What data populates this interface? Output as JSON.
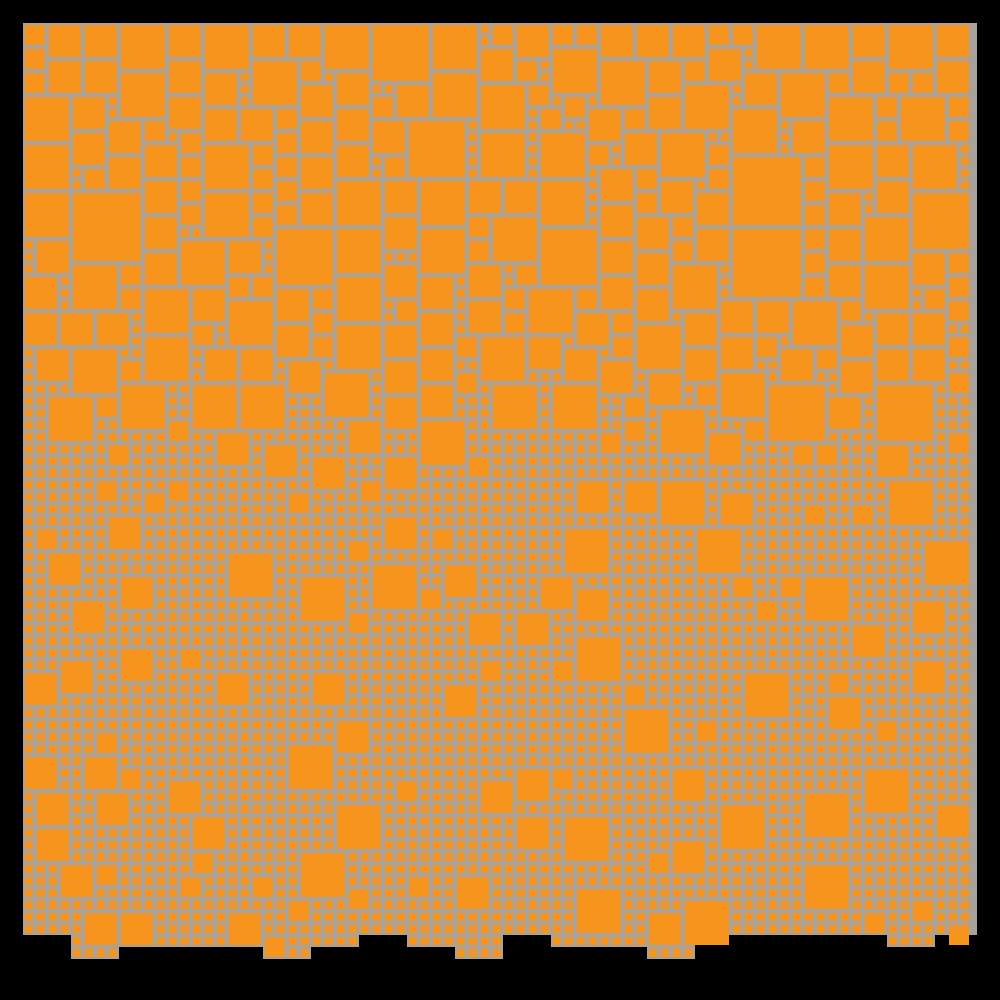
{
  "scene": {
    "description": "abstract-generative-square-mosaic",
    "text_content": "none"
  },
  "canvas": {
    "width": 1000,
    "height": 1000
  },
  "palette": {
    "frame_black": "#000000",
    "board_gray": "#a8a29b",
    "square_orange": "#f7941e"
  },
  "board": {
    "x": 23,
    "y": 23,
    "width": 954,
    "nominal_bottom": 971
  },
  "grid": {
    "cell": 12,
    "inset": 2,
    "cols": 79,
    "max_rows": 79,
    "square_sizes_px": {
      "1": 8,
      "2": 20,
      "3": 32,
      "4": 44,
      "5": 56,
      "6": 68
    }
  },
  "generator": {
    "seed": 1337,
    "block_cols": 4,
    "size_units": [
      1,
      2,
      3,
      4,
      5,
      6
    ],
    "top_weights": [
      0.12,
      0.1,
      0.31,
      0.34,
      0.09,
      0.04
    ],
    "bottom_weights": [
      0.948,
      0.018,
      0.02,
      0.014,
      0.0,
      0.0
    ],
    "transition": {
      "center_row": 31,
      "half_width_rows": 4,
      "block_noise_rows": 3
    },
    "bottom_limit_rows": [
      76,
      77,
      78,
      79
    ],
    "bottom_limit_weights": [
      0.3,
      0.3,
      0.25,
      0.15
    ],
    "overflow_prob": 0.35
  }
}
